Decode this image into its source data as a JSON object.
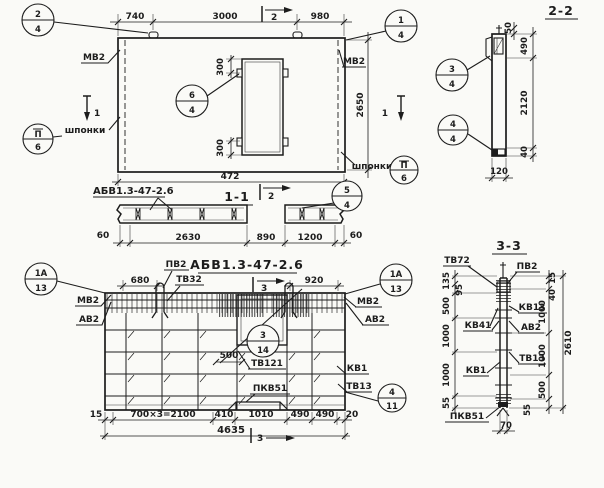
{
  "plan": {
    "dims": {
      "w1": "740",
      "w2": "3000",
      "w3": "980",
      "h": "2650",
      "total": "472",
      "o_top": "300",
      "o_bot": "300"
    },
    "mv2_left": "МВ2",
    "mv2_right": "МВ2",
    "shponki_left": "шпонки",
    "shponki_right": "шпонки",
    "marker_top": "2",
    "marker_left": "1",
    "marker_right": "1",
    "c24_top": "2",
    "c24_bot": "4",
    "c14_top": "1",
    "c14_bot": "4",
    "c64_top": "6",
    "c64_bot": "4",
    "cII6l_top": "П",
    "cII6l_bot": "6",
    "cII6r_top": "П",
    "cII6r_bot": "6"
  },
  "s22": {
    "title": "2-2",
    "d50": "50",
    "d490": "490",
    "d2120": "2120",
    "d40": "40",
    "d120": "120",
    "c34_top": "3",
    "c34_bot": "4",
    "c44_top": "4",
    "c44_bot": "4"
  },
  "s11": {
    "title": "1-1",
    "mark": "АБВ1.3-47-2.6",
    "marker": "2",
    "d1": "60",
    "d2": "2630",
    "d3": "890",
    "d4": "1200",
    "d5": "60",
    "c54_top": "5",
    "c54_bot": "4"
  },
  "elev": {
    "title": "АБВ1.3-47-2.6",
    "d680": "680",
    "d920": "920",
    "d500": "500",
    "pv2": "ПВ2",
    "tv32": "ТВ32",
    "mv2_l": "МВ2",
    "av2_l": "АВ2",
    "mv2_r": "МВ2",
    "av2_r": "АВ2",
    "kv1": "КВ1",
    "tv13": "ТВ13",
    "tv121": "ТВ121",
    "pkv51": "ПКВ51",
    "m3_top": "3",
    "m3_bot": "3",
    "b1": "15",
    "b2": "700×3=2100",
    "b3": "410",
    "b4": "1010",
    "b5": "490",
    "b6": "490",
    "b7": "20",
    "total": "4635",
    "c1a13l_top": "1А",
    "c1a13l_bot": "13",
    "c1a13r_top": "1А",
    "c1a13r_bot": "13",
    "c314_top": "3",
    "c314_bot": "14",
    "c411_top": "4",
    "c411_bot": "11"
  },
  "s33": {
    "title": "3-3",
    "tv72": "ТВ72",
    "pv2": "ПВ2",
    "kv13": "КВ13",
    "av2": "АВ2",
    "kv41": "КВ41",
    "tv13": "ТВ13",
    "kv1": "КВ1",
    "pkv51": "ПКВ51",
    "l1": "135",
    "l2": "95",
    "l3": "500",
    "l4": "1000",
    "l5": "1000",
    "l6": "55",
    "r1": "15",
    "r2": "40",
    "r3": "1000",
    "r4": "1000",
    "r5": "500",
    "r6": "55",
    "total": "2610",
    "d70": "70"
  }
}
